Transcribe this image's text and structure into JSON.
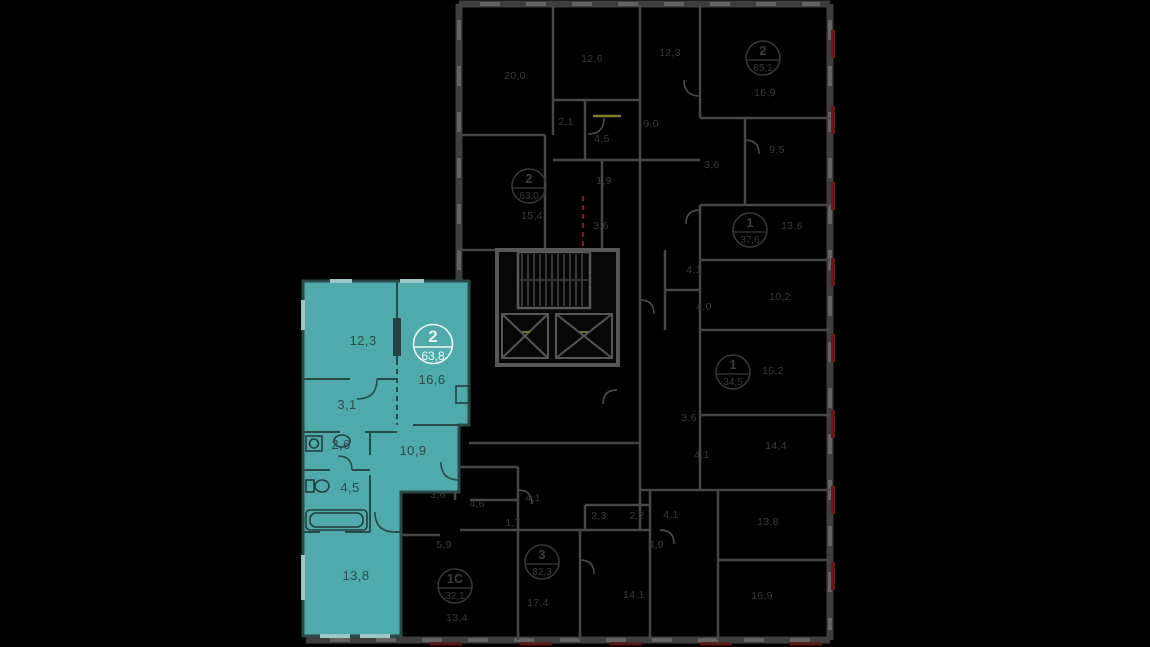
{
  "viewer": {
    "type": "residential-floor-plan",
    "colors": {
      "background": "#000000",
      "highlight_fill": "#4fabab",
      "highlight_wall": "#2b4949",
      "highlight_text": "#2e4a4a",
      "badge_text": "#eef7f7",
      "ghost_wall": "#474747",
      "ghost_text": "#3a3a3a",
      "accent_red": "#6b1515",
      "accent_yellow": "#7f7f2b"
    },
    "highlight_apartment": {
      "badge": {
        "rooms": "2",
        "area": "63,8",
        "x": 433,
        "y": 344
      },
      "room_areas": [
        {
          "label": "12,3",
          "x": 363,
          "y": 345
        },
        {
          "label": "16,6",
          "x": 432,
          "y": 384
        },
        {
          "label": "3,1",
          "x": 347,
          "y": 409
        },
        {
          "label": "2,6",
          "x": 341,
          "y": 449
        },
        {
          "label": "4,5",
          "x": 350,
          "y": 492
        },
        {
          "label": "10,9",
          "x": 413,
          "y": 455
        },
        {
          "label": "13,8",
          "x": 356,
          "y": 580
        }
      ]
    },
    "other_apartments": {
      "badges": [
        {
          "rooms": "2",
          "area": "63,0",
          "x": 529,
          "y": 186
        },
        {
          "rooms": "2",
          "area": "65,1",
          "x": 763,
          "y": 58
        },
        {
          "rooms": "1",
          "area": "37,6",
          "x": 750,
          "y": 230
        },
        {
          "rooms": "1",
          "area": "34,5",
          "x": 733,
          "y": 372
        },
        {
          "rooms": "3",
          "area": "82,3",
          "x": 542,
          "y": 562
        },
        {
          "rooms": "1С",
          "area": "32,1",
          "x": 455,
          "y": 586
        }
      ],
      "room_areas": [
        {
          "label": "20,0",
          "x": 515,
          "y": 79
        },
        {
          "label": "12,6",
          "x": 592,
          "y": 62
        },
        {
          "label": "12,3",
          "x": 670,
          "y": 56
        },
        {
          "label": "16,9",
          "x": 765,
          "y": 96
        },
        {
          "label": "2,1",
          "x": 566,
          "y": 125
        },
        {
          "label": "4,5",
          "x": 602,
          "y": 142
        },
        {
          "label": "9,0",
          "x": 651,
          "y": 127
        },
        {
          "label": "3,6",
          "x": 712,
          "y": 168
        },
        {
          "label": "9,5",
          "x": 777,
          "y": 153
        },
        {
          "label": "1,9",
          "x": 604,
          "y": 184
        },
        {
          "label": "3,6",
          "x": 601,
          "y": 229
        },
        {
          "label": "15,4",
          "x": 532,
          "y": 219
        },
        {
          "label": "13,6",
          "x": 792,
          "y": 229
        },
        {
          "label": "4,1",
          "x": 694,
          "y": 273
        },
        {
          "label": "4,0",
          "x": 704,
          "y": 310
        },
        {
          "label": "10,2",
          "x": 780,
          "y": 300
        },
        {
          "label": "16,2",
          "x": 773,
          "y": 374
        },
        {
          "label": "3,6",
          "x": 689,
          "y": 421
        },
        {
          "label": "4,1",
          "x": 702,
          "y": 458
        },
        {
          "label": "14,4",
          "x": 776,
          "y": 449
        },
        {
          "label": "4,1",
          "x": 671,
          "y": 518
        },
        {
          "label": "4,9",
          "x": 656,
          "y": 548
        },
        {
          "label": "13,8",
          "x": 768,
          "y": 525
        },
        {
          "label": "16,9",
          "x": 762,
          "y": 599
        },
        {
          "label": "3,6",
          "x": 438,
          "y": 498
        },
        {
          "label": "4,6",
          "x": 477,
          "y": 507
        },
        {
          "label": "4,1",
          "x": 533,
          "y": 501
        },
        {
          "label": "1,7",
          "x": 513,
          "y": 526
        },
        {
          "label": "5,9",
          "x": 444,
          "y": 548
        },
        {
          "label": "13,4",
          "x": 457,
          "y": 621
        },
        {
          "label": "17,4",
          "x": 538,
          "y": 606
        },
        {
          "label": "14,1",
          "x": 634,
          "y": 598
        },
        {
          "label": "2,3",
          "x": 599,
          "y": 519
        },
        {
          "label": "2,2",
          "x": 637,
          "y": 519
        }
      ]
    }
  }
}
